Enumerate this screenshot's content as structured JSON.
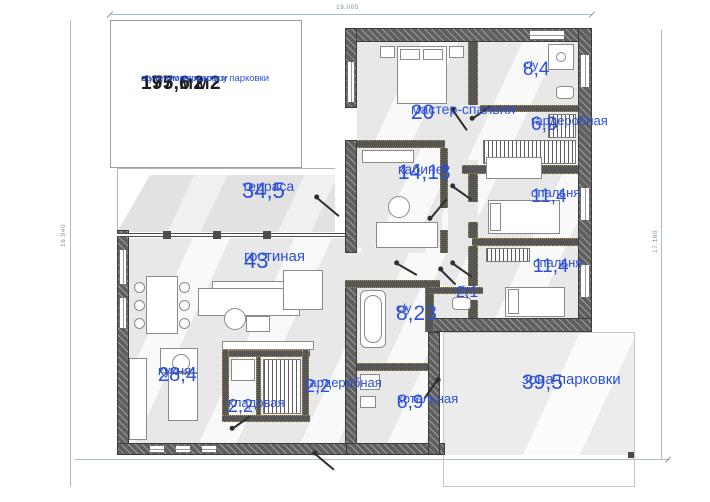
{
  "meta": {
    "summary": {
      "total_area": "197,6 м2",
      "total_note": "с учетом террасы и парковки",
      "heated_area": "175 м2",
      "heated_note": "по теплому контуру"
    },
    "dimensions": {
      "top": "19.005",
      "left": "16.940",
      "right": "17.180"
    },
    "colors": {
      "accent_blue": "#2b4fd7",
      "wall_gray": "#5f5f5f",
      "dim_blue": "#7e95a8"
    }
  },
  "rooms": [
    {
      "id": "terrace",
      "name": "терраса",
      "area": "34,5"
    },
    {
      "id": "master-bedroom",
      "name": "мастер-спальня",
      "area": "20"
    },
    {
      "id": "bathroom-main",
      "name": "с/у",
      "area": "8,4"
    },
    {
      "id": "wardrobe-main",
      "name": "гардеробная",
      "area": "6,9"
    },
    {
      "id": "study",
      "name": "кабинет",
      "area": "14,13"
    },
    {
      "id": "bedroom-1",
      "name": "спальня",
      "area": "11,4"
    },
    {
      "id": "bedroom-2",
      "name": "спальня",
      "area": "11,4"
    },
    {
      "id": "living-room",
      "name": "гостиная",
      "area": "43"
    },
    {
      "id": "bathroom-2",
      "name": "с/у",
      "area": "2,1"
    },
    {
      "id": "bathroom-3",
      "name": "с/у",
      "area": "8,23"
    },
    {
      "id": "kitchen",
      "name": "кухня",
      "area": "28,4"
    },
    {
      "id": "pantry",
      "name": "кладовая",
      "area": "2,2"
    },
    {
      "id": "wardrobe-2",
      "name": "гардеробная",
      "area": "2,2"
    },
    {
      "id": "boiler-room",
      "name": "котельная",
      "area": "8,9"
    },
    {
      "id": "parking",
      "name": "зона парковки",
      "area": "39,5"
    }
  ]
}
